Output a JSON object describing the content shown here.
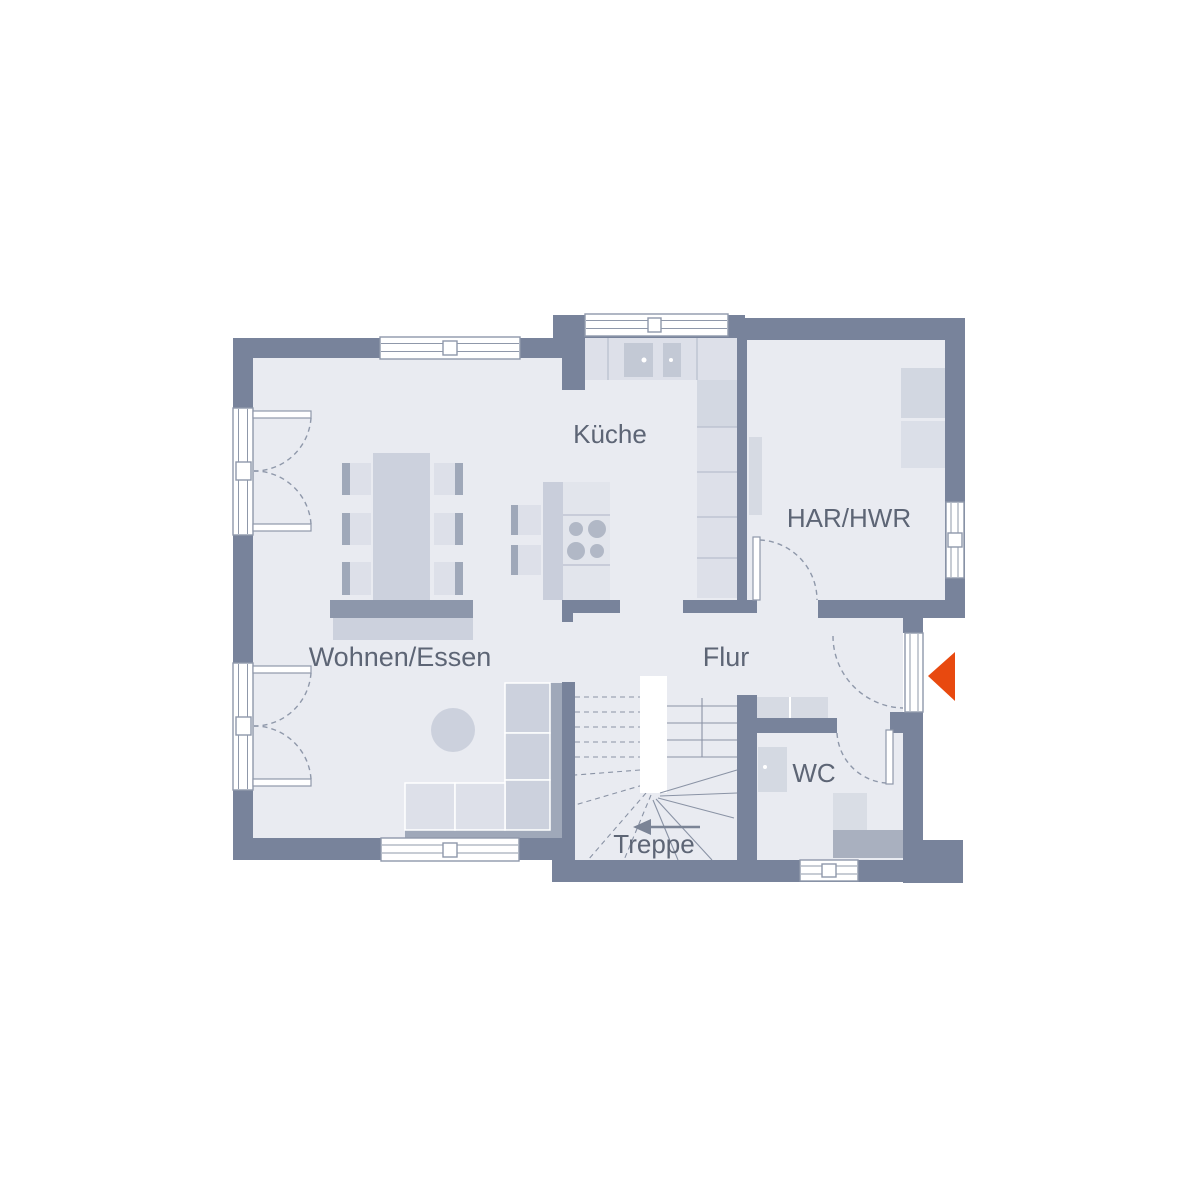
{
  "plan": {
    "type": "floor-plan-ground-floor",
    "rooms": [
      {
        "id": "kueche",
        "label": "Küche"
      },
      {
        "id": "har_hwr",
        "label": "HAR/HWR"
      },
      {
        "id": "wohnen_essen",
        "label": "Wohnen/Essen"
      },
      {
        "id": "flur",
        "label": "Flur"
      },
      {
        "id": "wc",
        "label": "WC"
      },
      {
        "id": "treppe",
        "label": "Treppe"
      }
    ],
    "entrance_marker": {
      "icon": "entrance-arrow-icon",
      "direction": "left",
      "color": "#e8490f"
    }
  },
  "colors": {
    "wall": "#78839b",
    "floor": "#e9ebf1",
    "outline": "#8f98aa",
    "counter_line": "#b8becd",
    "furniture_light": "#dde0e9",
    "furniture_mid": "#ccd1dd",
    "furniture_dark": "#9fa8b9",
    "fixture_gray": "#a9b0bf",
    "text": "#5d6575",
    "accent": "#e8490f",
    "frame_white": "#ffffff"
  }
}
